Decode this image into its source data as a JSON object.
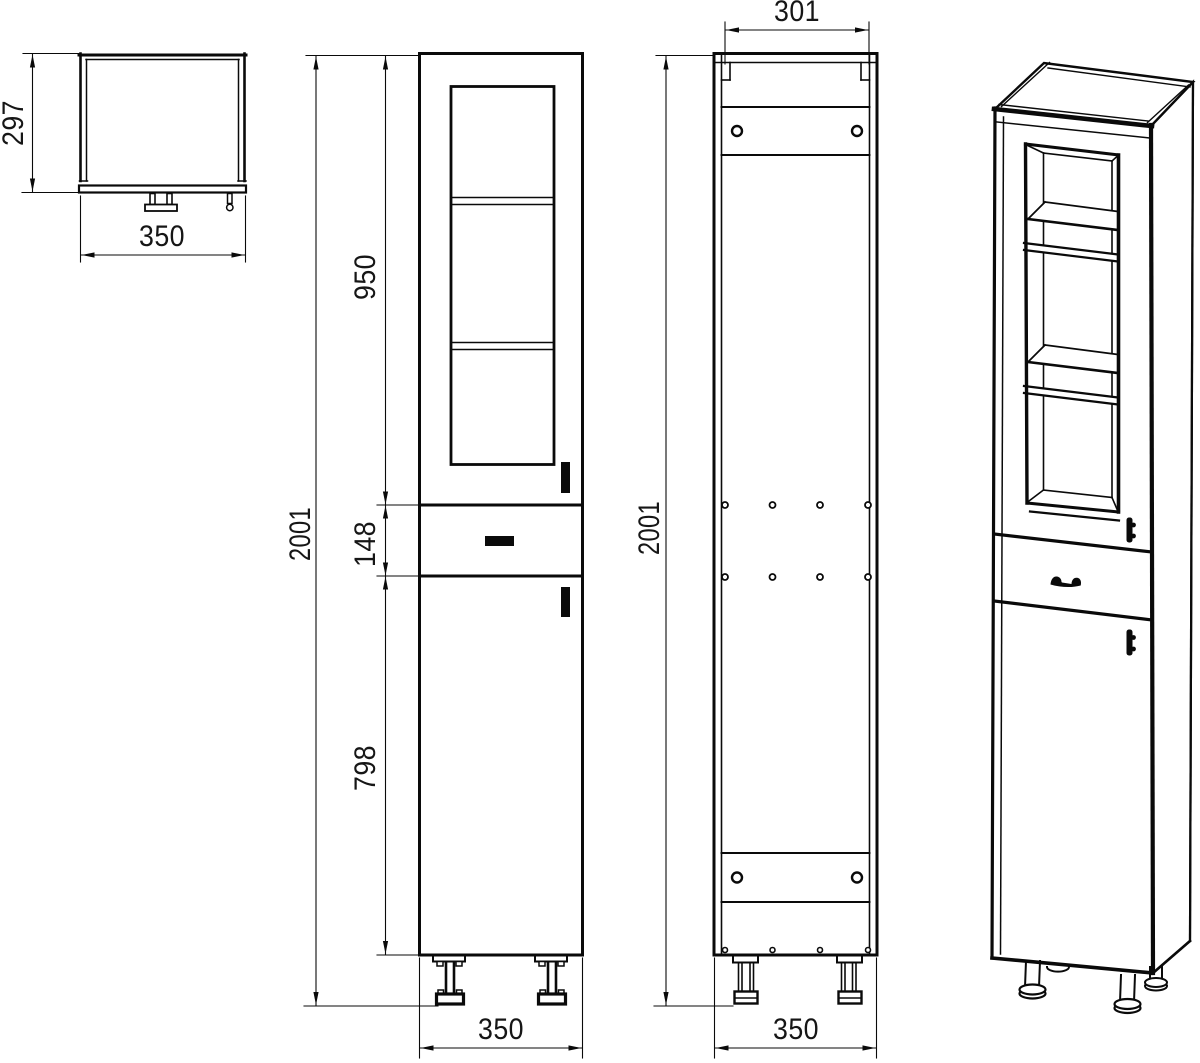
{
  "drawing": {
    "background_color": "#ffffff",
    "line_color": "#0a0a0a",
    "dimensions": {
      "top_view_depth": "297",
      "top_view_width": "350",
      "front_view_upper_door_height": "950",
      "front_view_total_height": "2001",
      "front_view_drawer_height": "148",
      "front_view_lower_door_height": "798",
      "front_view_width": "350",
      "back_view_inner_width": "301",
      "back_view_total_height": "2001",
      "back_view_width": "350"
    }
  }
}
